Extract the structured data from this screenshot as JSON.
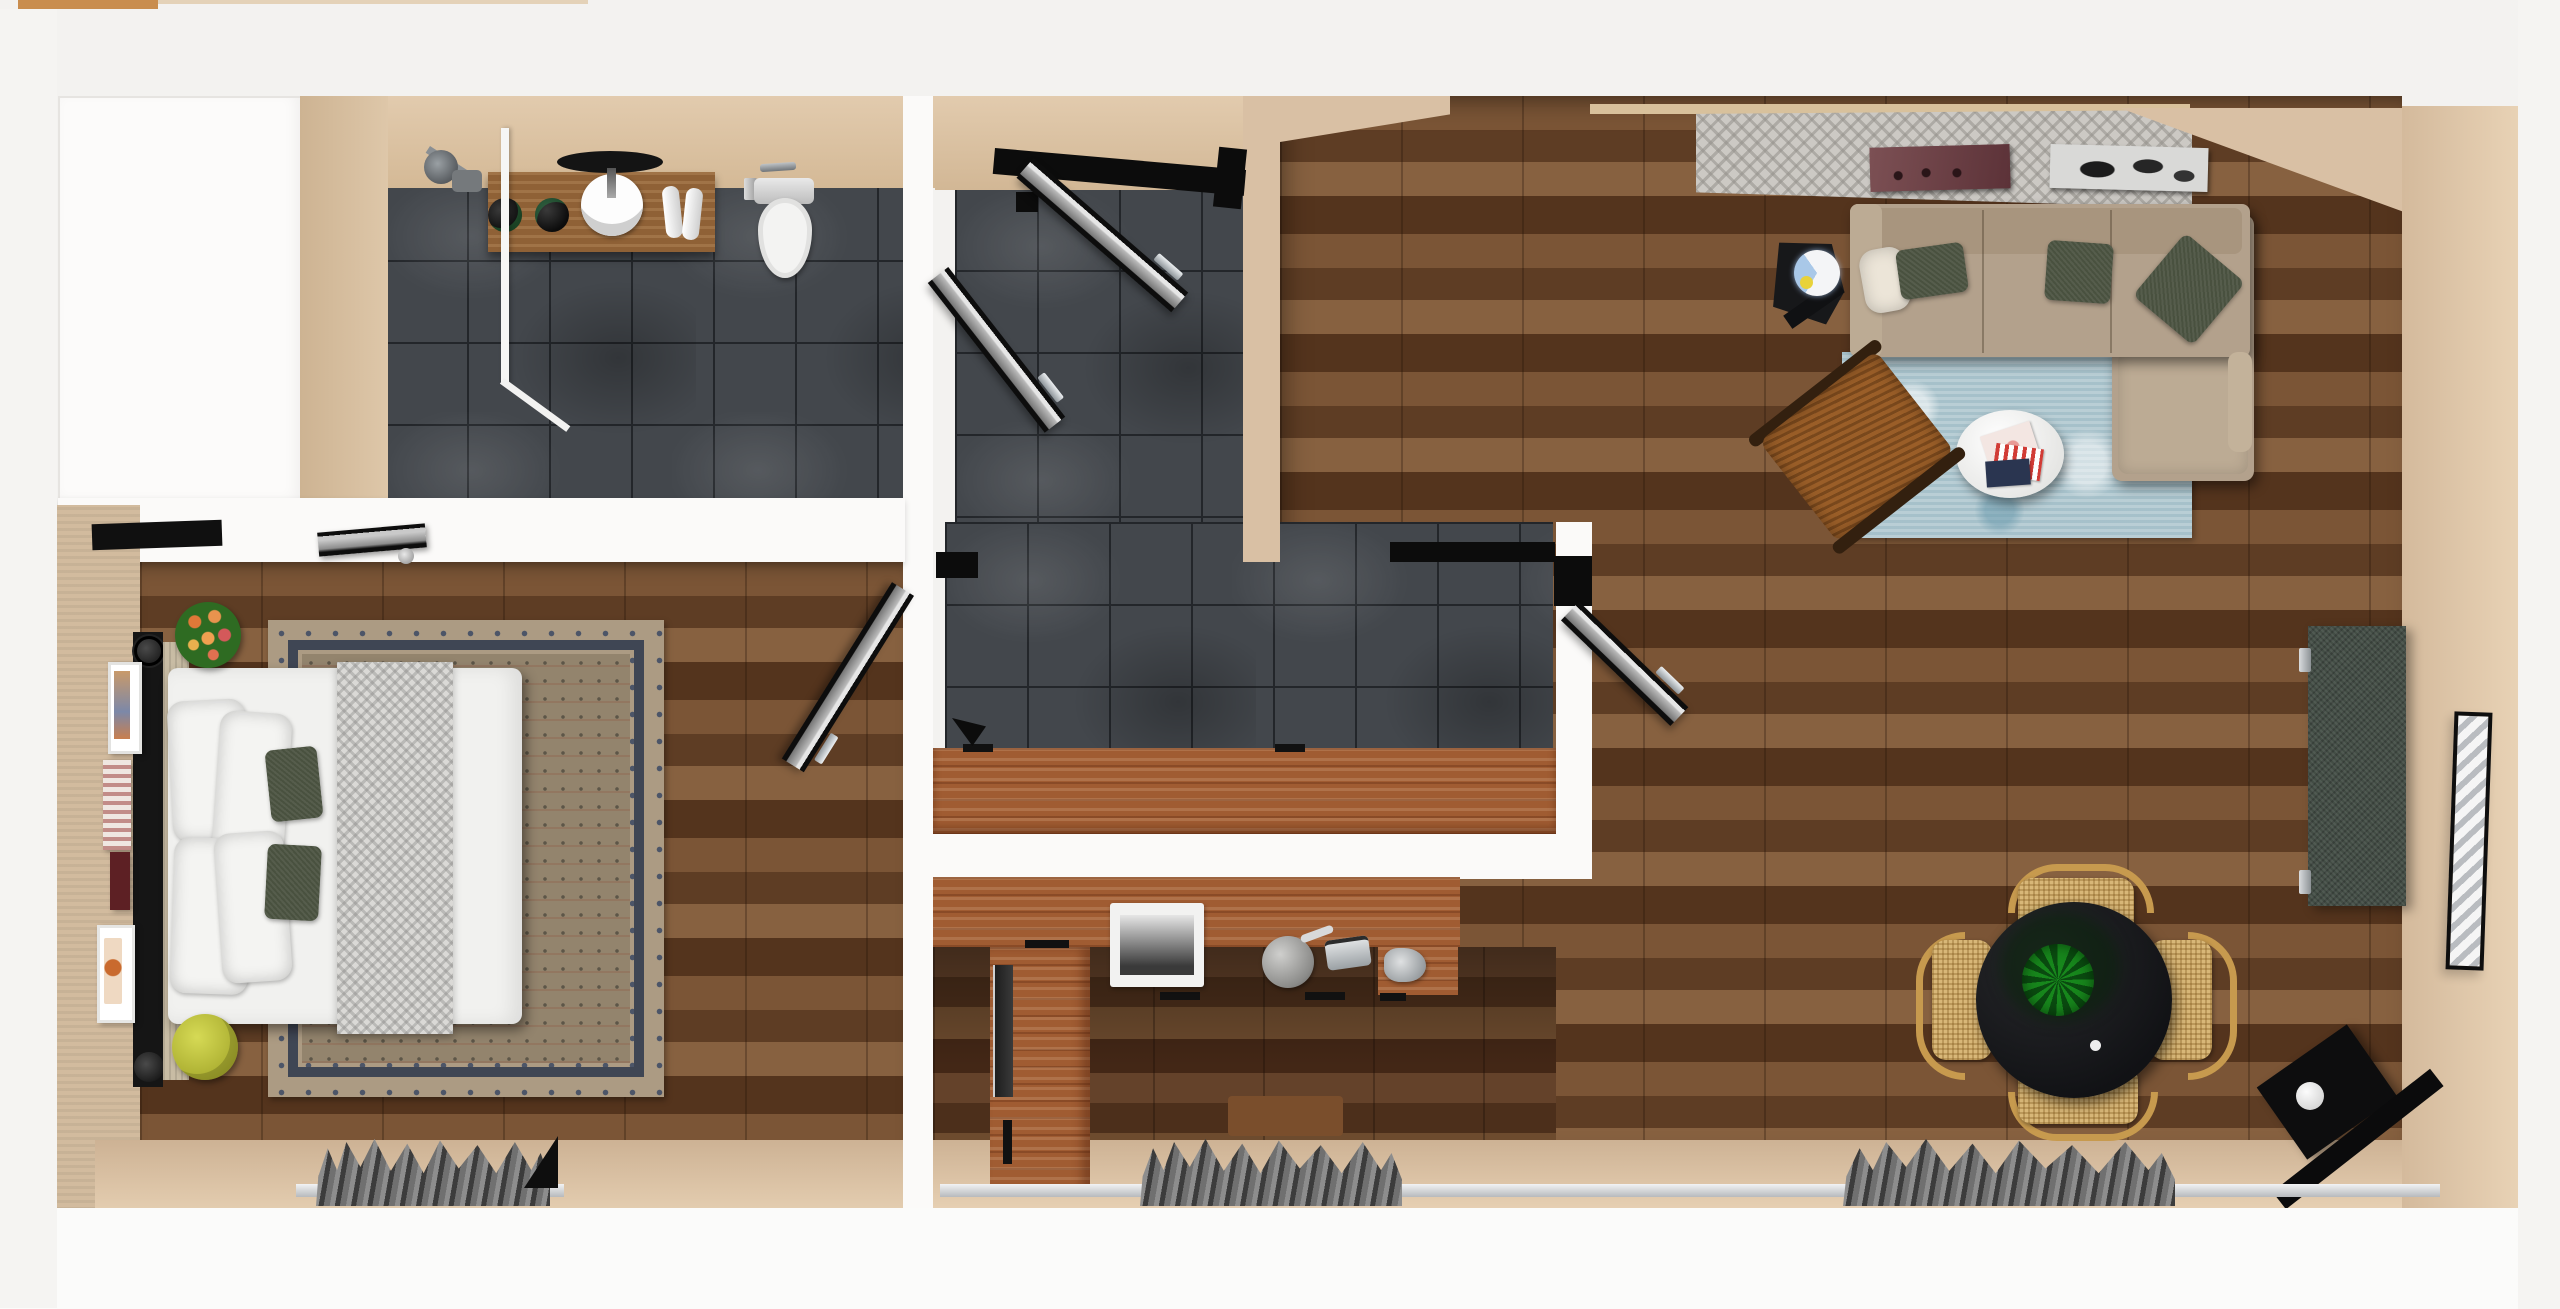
{
  "scene": {
    "type": "3d-floor-plan-render",
    "view": "top-down",
    "rooms": [
      "balcony",
      "bathroom",
      "entry-hall",
      "bedroom",
      "kitchen",
      "living-room",
      "dining-area"
    ]
  },
  "inventory": {
    "bathroom": [
      "wood-vanity",
      "round-mirror",
      "vessel-sink",
      "two-black-bowls",
      "rolled-towels",
      "toilet",
      "walk-in-shower",
      "glass-partition",
      "slate-tile-floor"
    ],
    "entry_hall": [
      "entry-door-open",
      "side-door-open",
      "slate-tile-floor",
      "breakfast-bar-counter"
    ],
    "bedroom": [
      "double-bed",
      "white-pillows-x4",
      "green-accent-pillows-x2",
      "herringbone-throw",
      "persian-rug",
      "black-headboard",
      "wall-art-frames-x4",
      "flower-bouquet-stool",
      "yellow-pouf",
      "window-curtain",
      "door-to-hall-open"
    ],
    "kitchen": [
      "l-shaped-counter",
      "inset-sink",
      "kettle",
      "toaster",
      "built-in-oven",
      "cutting-board",
      "window-curtain"
    ],
    "living_room": [
      "beige-sectional-sofa-with-chaise",
      "green-cushions-x3",
      "distressed-blue-rug",
      "white-oval-coffee-table",
      "magazines",
      "woven-lounge-chair",
      "black-side-table",
      "globe-lamp",
      "tv-media-panel",
      "leaning-mirror",
      "wall-art-x2",
      "patterned-accent-wall",
      "window-curtain",
      "black-folded-chair"
    ],
    "dining_area": [
      "round-black-table",
      "potted-plant",
      "rattan-chairs-x4"
    ]
  },
  "counts": {
    "rattan_chairs": 4,
    "white_pillows": 4,
    "green_sofa_cushions": 3,
    "wall_art_bedroom": 4
  },
  "colors": {
    "outer": "#f3f2f0",
    "wall-beige": "#d9c0a4",
    "wall-tan": "#cdb79c",
    "wall-white": "#fbfaf9",
    "slate": "#43474c",
    "grout": "#23262a",
    "wood": "#6f4c2f",
    "kitchen-wood": "#5c3b25",
    "counter": "#a05c32",
    "vanity": "#8f6136",
    "sofa": "#b3a18c",
    "sofa-dark": "#a8957e",
    "sofa-light": "#bcab94",
    "pillow-green": "#49513f",
    "rug-blue": "#aec6ce",
    "rug-tan": "#ac9b83",
    "rug-navy": "#3f4654",
    "rug-field": "#93846d",
    "curtain": "#6d6d6d",
    "sill": "#dfe1e2",
    "black": "#121214",
    "rattan": "#d8b778",
    "rattan-frame": "#c79a4e",
    "plant": "#17871c",
    "plant-dark": "#0a4b10",
    "tv-panel": "#434d45",
    "bed-white": "#f1f1ef",
    "throw-gray": "#dad9d6",
    "lamp-blue": "#a9c8e8",
    "pouf-yellow": "#bfc23d",
    "flower-green": "#2e6b22"
  }
}
